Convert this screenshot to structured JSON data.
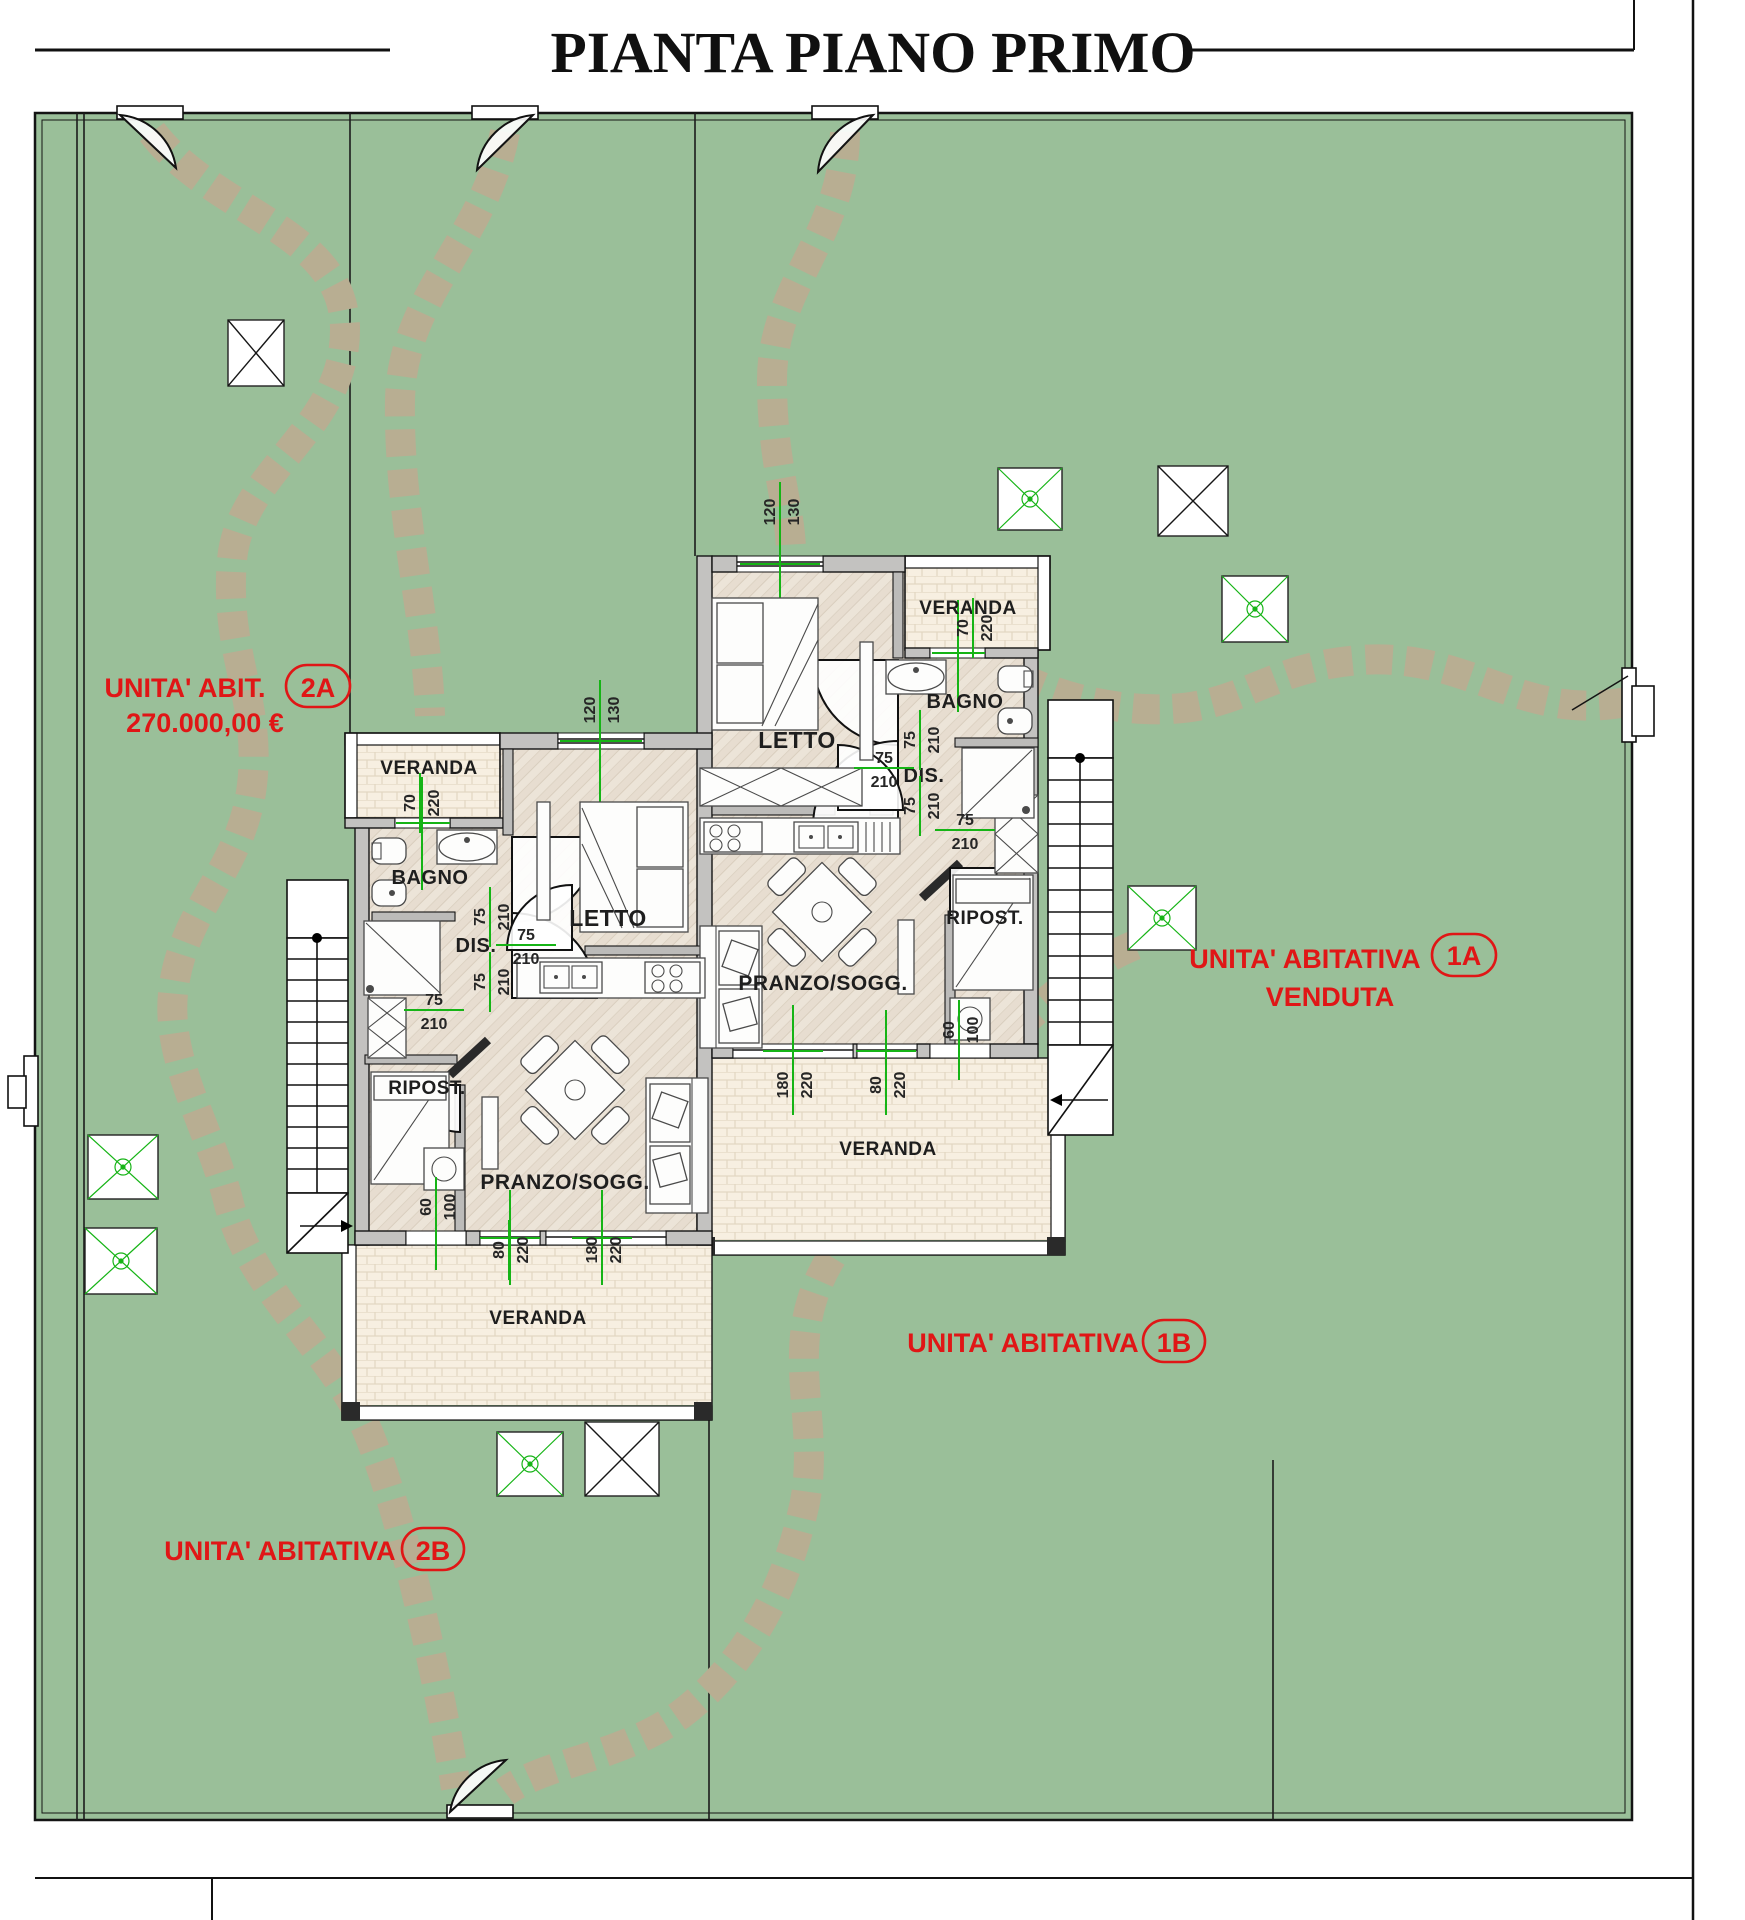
{
  "title": "PIANTA PIANO PRIMO",
  "colors": {
    "garden_green": "#9abf99",
    "path_stone": "#b8ae92",
    "wall_gray": "#c3c2c0",
    "interior_floor": "#ece4d8",
    "veranda_floor": "#f7efe1",
    "dimension_green": "#16b416",
    "label_red": "#e01616",
    "line_black": "#141414"
  },
  "unit_labels": [
    {
      "name": "UNITA' ABIT.",
      "badge": "2A",
      "price": "270.000,00 €"
    },
    {
      "name": "UNITA' ABITATIVA",
      "badge": "1A",
      "status": "VENDUTA"
    },
    {
      "name": "UNITA' ABITATIVA",
      "badge": "1B"
    },
    {
      "name": "UNITA' ABITATIVA",
      "badge": "2B"
    }
  ],
  "rooms": [
    {
      "name": "VERANDA",
      "x": 968,
      "y": 614,
      "size": 19
    },
    {
      "name": "BAGNO",
      "x": 965,
      "y": 708,
      "size": 20
    },
    {
      "name": "LETTO",
      "x": 797,
      "y": 748,
      "size": 23
    },
    {
      "name": "DIS.",
      "x": 924,
      "y": 782,
      "size": 20
    },
    {
      "name": "RIPOST.",
      "x": 985,
      "y": 924,
      "size": 19
    },
    {
      "name": "PRANZO/SOGG.",
      "x": 823,
      "y": 990,
      "size": 21
    },
    {
      "name": "VERANDA",
      "x": 888,
      "y": 1155,
      "size": 19
    },
    {
      "name": "VERANDA",
      "x": 429,
      "y": 774,
      "size": 19
    },
    {
      "name": "BAGNO",
      "x": 430,
      "y": 884,
      "size": 20
    },
    {
      "name": "LETTO",
      "x": 608,
      "y": 926,
      "size": 23
    },
    {
      "name": "DIS.",
      "x": 476,
      "y": 952,
      "size": 20
    },
    {
      "name": "RIPOST.",
      "x": 427,
      "y": 1094,
      "size": 19
    },
    {
      "name": "PRANZO/SOGG.",
      "x": 565,
      "y": 1189,
      "size": 21
    },
    {
      "name": "VERANDA",
      "x": 538,
      "y": 1324,
      "size": 19
    }
  ],
  "dimensions": [
    {
      "a": "120",
      "b": "130",
      "x": 780,
      "y": 512,
      "rot": -90
    },
    {
      "a": "70",
      "b": "220",
      "x": 973,
      "y": 628,
      "rot": -90
    },
    {
      "a": "75",
      "b": "210",
      "x": 920,
      "y": 740,
      "rot": -90
    },
    {
      "a": "75",
      "b": "210",
      "x": 884,
      "y": 768,
      "rot": 0
    },
    {
      "a": "75",
      "b": "210",
      "x": 920,
      "y": 806,
      "rot": -90
    },
    {
      "a": "75",
      "b": "210",
      "x": 965,
      "y": 830,
      "rot": 0
    },
    {
      "a": "60",
      "b": "100",
      "x": 959,
      "y": 1030,
      "rot": -90
    },
    {
      "a": "180",
      "b": "220",
      "x": 793,
      "y": 1085,
      "rot": -90
    },
    {
      "a": "80",
      "b": "220",
      "x": 886,
      "y": 1085,
      "rot": -90
    },
    {
      "a": "120",
      "b": "130",
      "x": 600,
      "y": 710,
      "rot": -90
    },
    {
      "a": "70",
      "b": "220",
      "x": 420,
      "y": 803,
      "rot": -90
    },
    {
      "a": "75",
      "b": "210",
      "x": 490,
      "y": 917,
      "rot": -90
    },
    {
      "a": "75",
      "b": "210",
      "x": 526,
      "y": 945,
      "rot": 0
    },
    {
      "a": "75",
      "b": "210",
      "x": 490,
      "y": 982,
      "rot": -90
    },
    {
      "a": "75",
      "b": "210",
      "x": 434,
      "y": 1010,
      "rot": 0
    },
    {
      "a": "60",
      "b": "100",
      "x": 436,
      "y": 1207,
      "rot": -90
    },
    {
      "a": "80",
      "b": "220",
      "x": 509,
      "y": 1250,
      "rot": -90
    },
    {
      "a": "180",
      "b": "220",
      "x": 602,
      "y": 1250,
      "rot": -90
    }
  ]
}
